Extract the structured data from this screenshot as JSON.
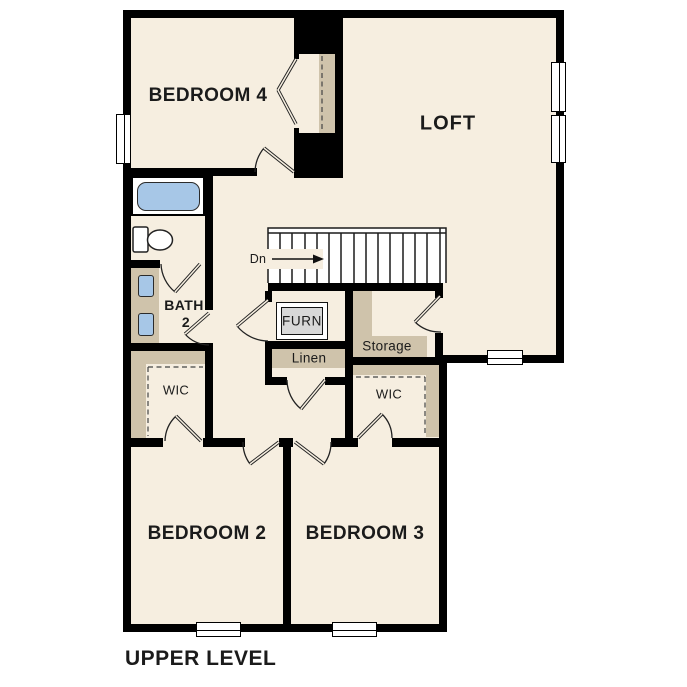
{
  "title": "UPPER LEVEL",
  "rooms": {
    "bedroom4": "BEDROOM 4",
    "loft": "LOFT",
    "bedroom2": "BEDROOM 2",
    "bedroom3": "BEDROOM 3",
    "bath_line1": "BATH",
    "bath_line2": "2",
    "wic_left": "WIC",
    "wic_right": "WIC",
    "linen": "Linen",
    "storage": "Storage",
    "furnace": "FURN",
    "stairs_direction": "Dn"
  },
  "colors": {
    "floor": "#f6eee0",
    "wall": "#000000",
    "shelf_tan": "#cfc3ab",
    "fixture_blue": "#a7c7e7",
    "furnace_gray": "#d8d8d8",
    "text": "#1b1b1b"
  }
}
